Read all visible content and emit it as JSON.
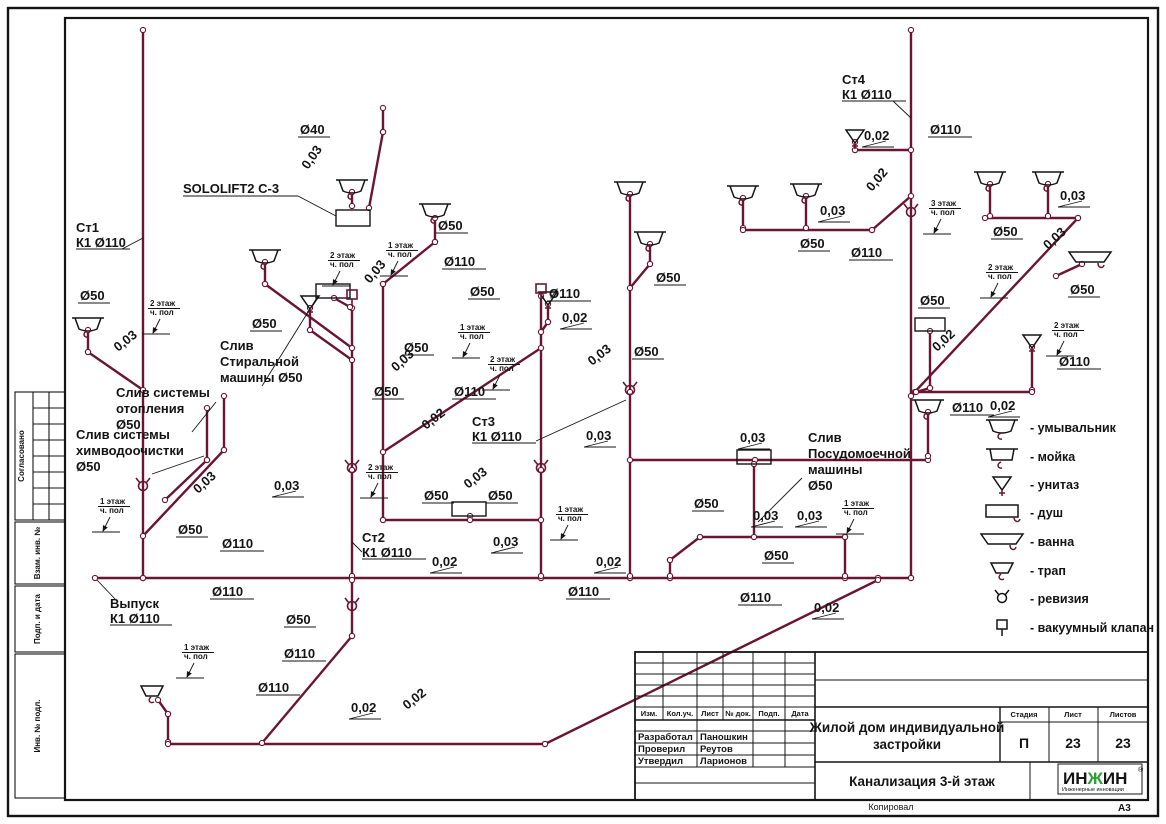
{
  "colors": {
    "pipe": "#6b1630",
    "ink": "#141414",
    "logo_green": "#2e9e36"
  },
  "labels": {
    "d40": "Ø40",
    "d50": "Ø50",
    "d110": "Ø110",
    "s002": "0,02",
    "s003": "0,03",
    "fl1": "1 этаж",
    "fl2": "2 этаж",
    "fl3": "3 этаж",
    "chp": "ч. пол"
  },
  "callouts": {
    "st1": [
      "Ст1",
      "К1 Ø110"
    ],
    "st2": [
      "Ст2",
      "К1 Ø110"
    ],
    "st3": [
      "Ст3",
      "К1 Ø110"
    ],
    "st4": [
      "Ст4",
      "К1 Ø110"
    ],
    "vypusk": [
      "Выпуск",
      "К1 Ø110"
    ],
    "sololift": "SOLOLIFT2 C-3",
    "washer": [
      "Слив",
      "Стиральной",
      "машины Ø50"
    ],
    "heating": [
      "Слив системы",
      "отопления",
      "Ø50"
    ],
    "chem": [
      "Слив системы",
      "химводоочистки",
      "Ø50"
    ],
    "dishwasher": [
      "Слив",
      "Посудомоечной",
      "машины",
      "Ø50"
    ]
  },
  "margin": {
    "soglasovano": "Согласовано",
    "vzam": "Взам. инв. №",
    "podp": "Подп. и дата",
    "inv": "Инв. № подл."
  },
  "legend": {
    "items": [
      {
        "icon": "washbasin-icon",
        "label": "- умывальник"
      },
      {
        "icon": "sink-icon",
        "label": "- мойка"
      },
      {
        "icon": "toilet-icon",
        "label": "- унитаз"
      },
      {
        "icon": "shower-icon",
        "label": "- душ"
      },
      {
        "icon": "bath-icon",
        "label": "- ванна"
      },
      {
        "icon": "floor-drain-icon",
        "label": "- трап"
      },
      {
        "icon": "revision-icon",
        "label": "- ревизия"
      },
      {
        "icon": "vacuum-valve-icon",
        "label": "- вакуумный клапан"
      }
    ]
  },
  "titleblock": {
    "cols": {
      "izm": "Изм.",
      "kol": "Кол.уч.",
      "list": "Лист",
      "doc": "№ док.",
      "podp": "Подп.",
      "data": "Дата"
    },
    "roles": [
      "Разработал",
      "Проверил",
      "Утвердил"
    ],
    "names": [
      "Паношкин",
      "Реутов",
      "Ларионов"
    ],
    "project_line1": "Жилой дом индивидуальной",
    "project_line2": "застройки",
    "drawing": "Канализация 3-й этаж",
    "stage_h": "Стадия",
    "sheet_h": "Лист",
    "sheets_h": "Листов",
    "stage": "П",
    "sheet": "23",
    "sheets": "23",
    "logo": {
      "p1": "ИН",
      "p2": "Ж",
      "p3": "ИН",
      "reg": "®",
      "sub": "Инженерные инновации"
    },
    "kopiroval": "Копировал",
    "format": "А3"
  }
}
